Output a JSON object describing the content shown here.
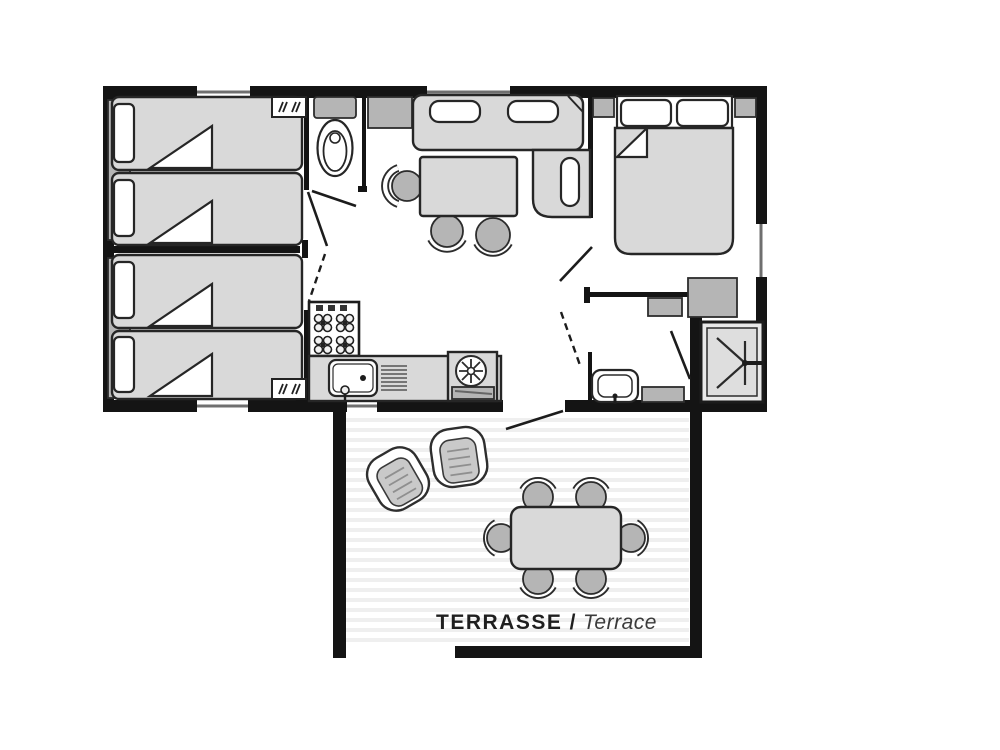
{
  "terrace": {
    "label_fr": "TERRASSE /",
    "label_en": "Terrace"
  },
  "colors": {
    "wall": "#141414",
    "furniture_fill": "#d9d9d9",
    "furniture_mid": "#b5b5b5",
    "outline": "#262626",
    "window_line": "#6f6f6f",
    "deck_stripe": "#efefef",
    "label_fr_text": "#1f1f1f",
    "label_en_text": "#3a3a3a",
    "background": "#ffffff"
  },
  "rooms": [
    {
      "name": "twin-bedroom-top",
      "items": [
        "single-bed",
        "single-bed",
        "pillow",
        "pillow",
        "wardrobe-shelves"
      ]
    },
    {
      "name": "twin-bedroom-bottom",
      "items": [
        "single-bed",
        "single-bed",
        "pillow",
        "pillow",
        "wardrobe-shelves"
      ]
    },
    {
      "name": "wc",
      "items": [
        "toilet"
      ]
    },
    {
      "name": "living-dining",
      "items": [
        "sofa",
        "sofa-cushion",
        "sofa-cushion",
        "side-cabinet",
        "corner-seat",
        "dining-table",
        "dining-chair",
        "dining-chair",
        "dining-chair"
      ]
    },
    {
      "name": "kitchen",
      "items": [
        "gas-hob",
        "worktop",
        "sink",
        "draining-board",
        "refrigerator"
      ]
    },
    {
      "name": "double-bedroom",
      "items": [
        "double-bed",
        "pillow",
        "pillow",
        "nightstand",
        "nightstand",
        "wardrobe",
        "cabinet"
      ]
    },
    {
      "name": "shower-room",
      "items": [
        "shower",
        "washbasin",
        "cabinet"
      ]
    },
    {
      "name": "terrace",
      "items": [
        "garden-table",
        "garden-chair",
        "garden-chair",
        "garden-chair",
        "garden-chair",
        "garden-chair",
        "garden-chair",
        "lounge-chair",
        "lounge-chair"
      ]
    }
  ]
}
